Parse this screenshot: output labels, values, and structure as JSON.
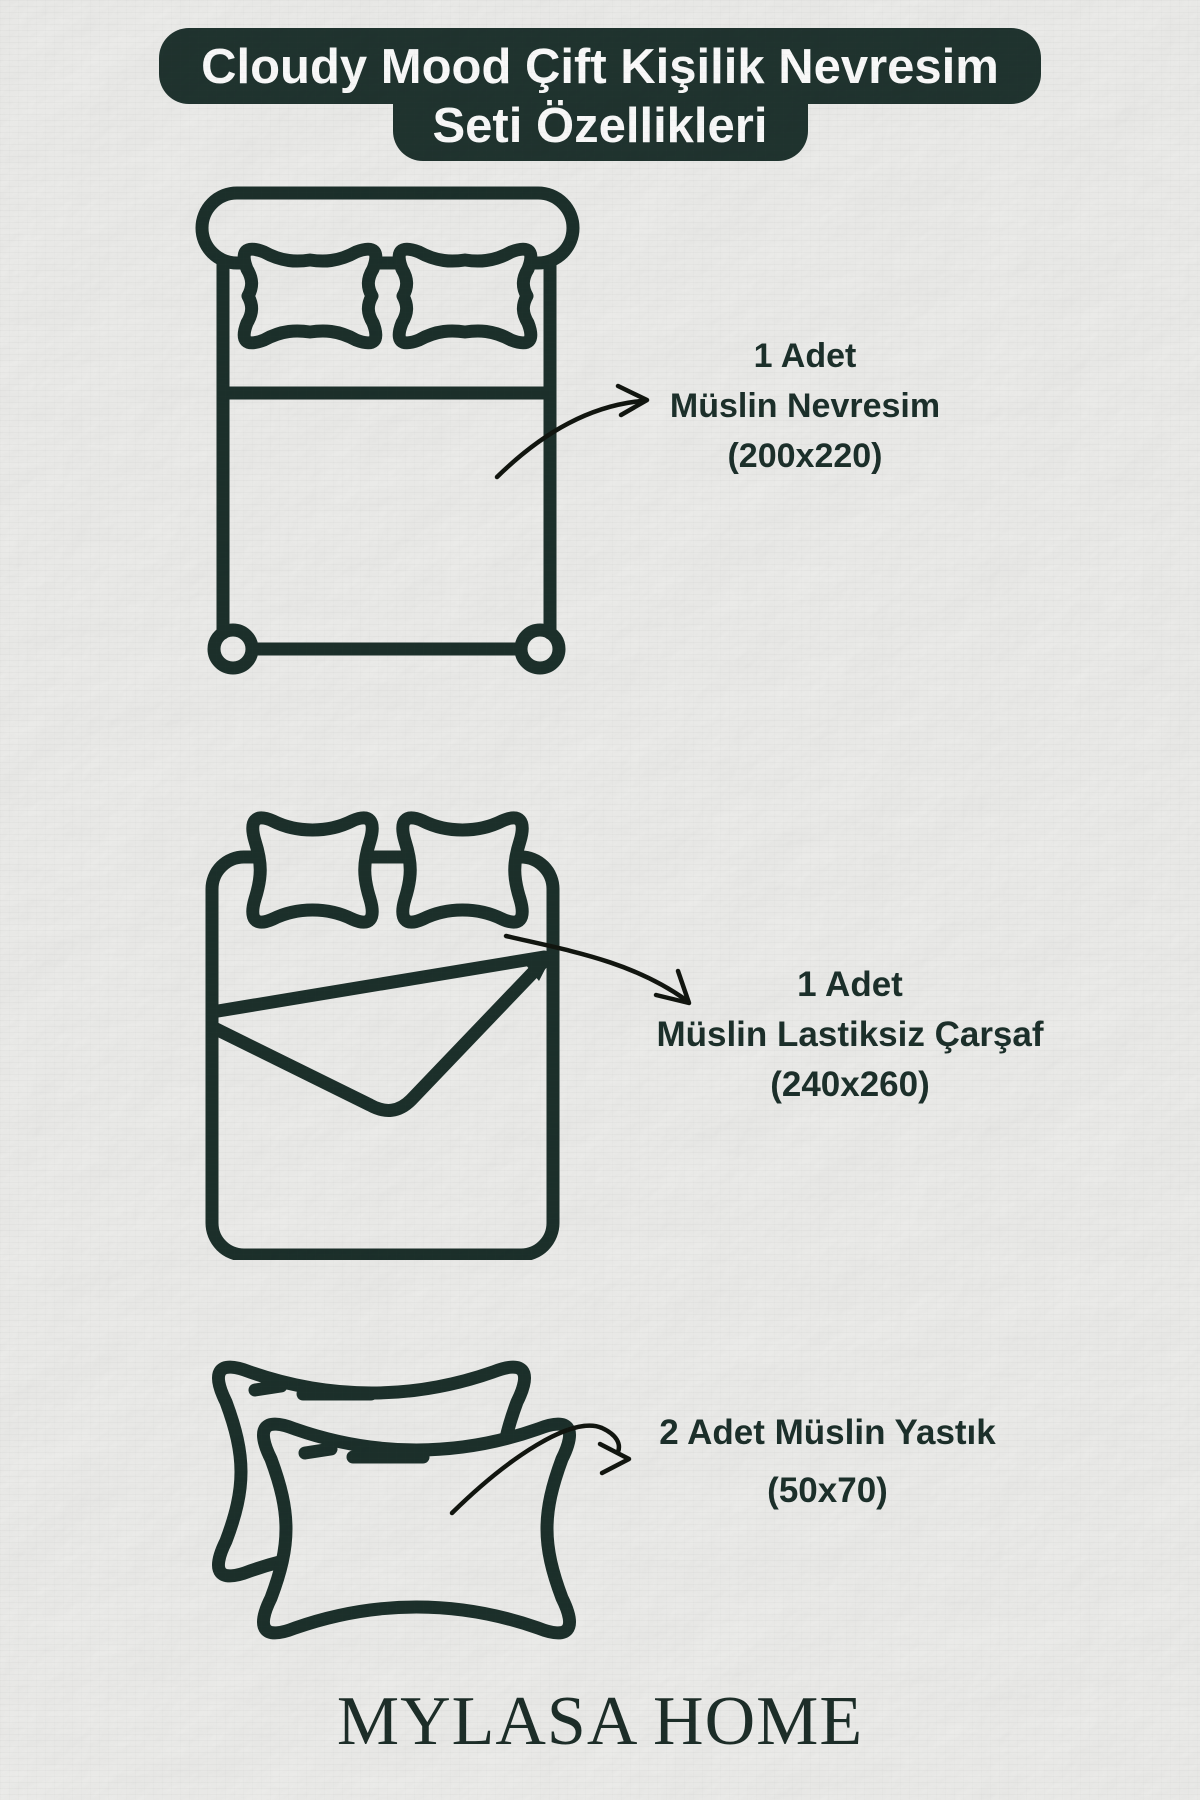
{
  "canvas": {
    "width": 1200,
    "height": 1800
  },
  "colors": {
    "paper": "#f0f0ee",
    "ink": "#1c302b",
    "title_bg": "#20342f",
    "title_text": "#ffffff",
    "arrow": "#11150f"
  },
  "title": {
    "line1": "Cloudy Mood Çift Kişilik Nevresim",
    "line2": "Seti Özellikleri"
  },
  "items": [
    {
      "icon": "double-bed-top-view-icon",
      "lines": [
        "1 Adet",
        "Müslin Nevresim",
        "(200x220)"
      ]
    },
    {
      "icon": "bed-flat-sheet-icon",
      "lines": [
        "1 Adet",
        "Müslin Lastiksiz Çarşaf",
        "(240x260)"
      ]
    },
    {
      "icon": "two-pillows-icon",
      "lines": [
        "2 Adet Müslin Yastık",
        "(50x70)"
      ]
    }
  ],
  "brand": {
    "name": "MYLASA HOME"
  }
}
